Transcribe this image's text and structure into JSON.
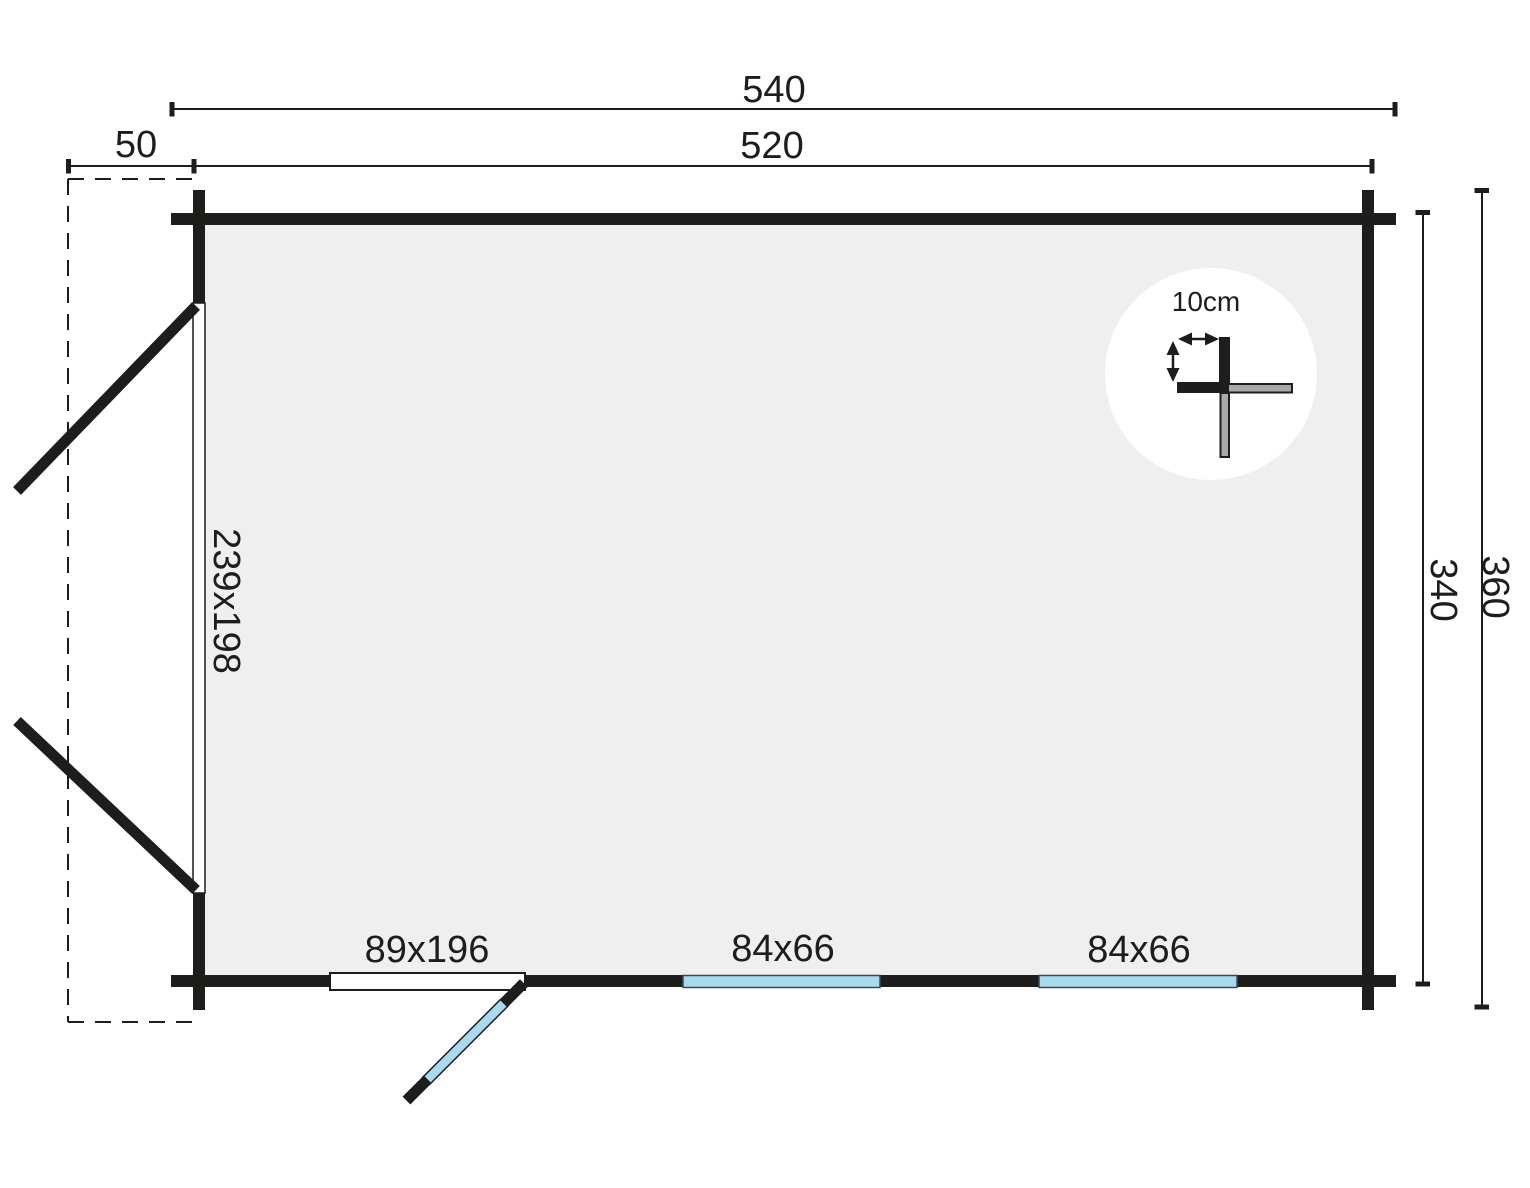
{
  "diagram": {
    "type": "log-cabin floor plan, top view",
    "labels": {
      "overall_width": "540",
      "wall_to_wall_width": "520",
      "side_overhang": "50",
      "overall_depth": "360",
      "wall_to_wall_depth": "340",
      "double_door_size": "239x198",
      "front_door_size": "89x196",
      "window_1_size": "84x66",
      "window_2_size": "84x66",
      "wall_thickness": "10cm"
    },
    "colors": {
      "line_black": "#1d1d1b",
      "interior_fill": "#efefef",
      "window_blue": "#a7d9ef",
      "log_gray": "#a9a9a9",
      "background": "#ffffff"
    }
  }
}
